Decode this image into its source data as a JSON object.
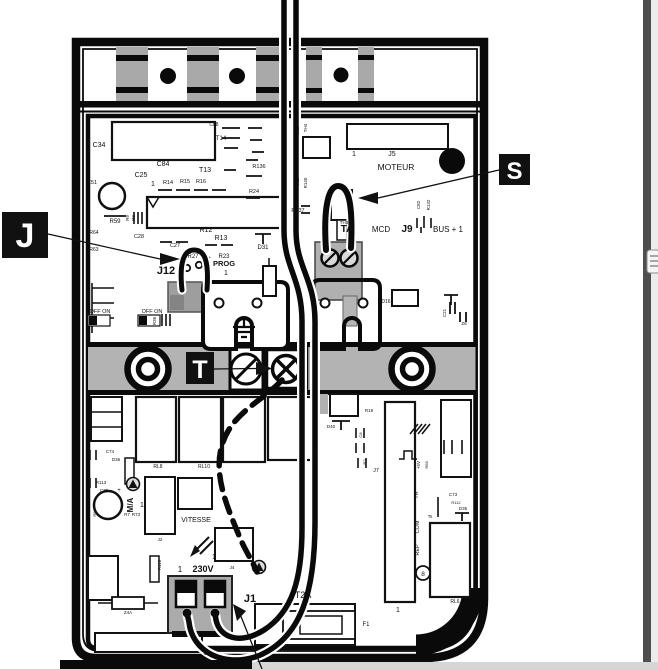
{
  "figure": {
    "type": "control-board-wiring-diagram",
    "accent_black": "#111111",
    "band_gray": "#b3b3b3",
    "cell_gray": "#a9a9a9",
    "block_gray": "#aeaeae",
    "page_strip_dark": "#4e4e4e",
    "page_strip_light": "#ececec",
    "bottom_bar_gray": "#d6d6d6"
  },
  "callouts": {
    "j": {
      "letter": "J"
    },
    "s": {
      "letter": "S"
    },
    "t": {
      "letter": "T"
    }
  },
  "board_labels": [
    {
      "t": "C34",
      "x": 99,
      "y": 147,
      "s": 7
    },
    {
      "t": "C84",
      "x": 163,
      "y": 166,
      "s": 7
    },
    {
      "t": "C25",
      "x": 141,
      "y": 177,
      "s": 7
    },
    {
      "t": "T13",
      "x": 205,
      "y": 172,
      "s": 7
    },
    {
      "t": "T14",
      "x": 221,
      "y": 140,
      "s": 6
    },
    {
      "t": "C88",
      "x": 214,
      "y": 126,
      "s": 5
    },
    {
      "t": "1",
      "x": 153,
      "y": 186,
      "s": 7
    },
    {
      "t": "R14",
      "x": 168,
      "y": 184,
      "s": 5.5
    },
    {
      "t": "R15",
      "x": 185,
      "y": 183,
      "s": 5.5
    },
    {
      "t": "R16",
      "x": 201,
      "y": 183,
      "s": 5.5
    },
    {
      "t": "R136",
      "x": 259,
      "y": 168,
      "s": 5.5
    },
    {
      "t": "R24",
      "x": 254,
      "y": 193,
      "s": 5.5
    },
    {
      "t": "C51",
      "x": 92,
      "y": 184,
      "s": 5.5
    },
    {
      "t": "R59",
      "x": 115,
      "y": 223,
      "s": 6
    },
    {
      "t": "R9",
      "x": 129,
      "y": 218,
      "s": 4.5,
      "r": 1
    },
    {
      "t": "R8",
      "x": 135,
      "y": 218,
      "s": 4.5,
      "r": 1
    },
    {
      "t": "R12",
      "x": 206,
      "y": 232,
      "s": 7
    },
    {
      "t": "R13",
      "x": 221,
      "y": 240,
      "s": 7
    },
    {
      "t": "C27",
      "x": 175,
      "y": 247,
      "s": 5.5
    },
    {
      "t": "C28",
      "x": 139,
      "y": 238,
      "s": 5.5
    },
    {
      "t": "D31",
      "x": 263,
      "y": 249,
      "s": 6
    },
    {
      "t": "R27",
      "x": 193,
      "y": 258,
      "s": 6
    },
    {
      "t": "R23",
      "x": 224,
      "y": 258,
      "s": 6
    },
    {
      "t": "R64",
      "x": 94,
      "y": 234,
      "s": 5
    },
    {
      "t": "R63",
      "x": 94,
      "y": 251,
      "s": 5
    },
    {
      "t": "J12",
      "x": 166,
      "y": 274,
      "s": 11,
      "b": 1
    },
    {
      "t": "PROG",
      "x": 224,
      "y": 266,
      "s": 7.5,
      "b": 1
    },
    {
      "t": "1",
      "x": 226,
      "y": 275,
      "s": 7
    },
    {
      "t": "OFF ON",
      "x": 100,
      "y": 313,
      "s": 5.5
    },
    {
      "t": "OFF ON",
      "x": 152,
      "y": 313,
      "s": 5.5
    },
    {
      "t": "R36",
      "x": 156,
      "y": 321,
      "s": 4.5,
      "r": 1
    },
    {
      "t": "U12",
      "x": 299,
      "y": 131,
      "s": 4.5,
      "r": 1
    },
    {
      "t": "TH4",
      "x": 307,
      "y": 128,
      "s": 4.5,
      "r": 1
    },
    {
      "t": "1",
      "x": 354,
      "y": 156,
      "s": 7
    },
    {
      "t": "J5",
      "x": 392,
      "y": 156,
      "s": 7
    },
    {
      "t": "MOTEUR",
      "x": 396,
      "y": 170,
      "s": 8.5
    },
    {
      "t": "U11",
      "x": 299,
      "y": 182,
      "s": 4.5,
      "r": 1
    },
    {
      "t": "R140",
      "x": 307,
      "y": 183,
      "s": 4.5,
      "r": 1
    },
    {
      "t": "R137",
      "x": 298,
      "y": 212,
      "s": 5.5
    },
    {
      "t": "TH3",
      "x": 344,
      "y": 224,
      "s": 4.5
    },
    {
      "t": "TA",
      "x": 347,
      "y": 232,
      "s": 10,
      "b": 1
    },
    {
      "t": "MCD",
      "x": 381,
      "y": 232,
      "s": 8
    },
    {
      "t": "J9",
      "x": 407,
      "y": 232,
      "s": 10,
      "b": 1
    },
    {
      "t": "BUS + 1",
      "x": 448,
      "y": 232,
      "s": 8
    },
    {
      "t": "C82",
      "x": 420,
      "y": 205,
      "s": 4.5,
      "r": 1
    },
    {
      "t": "R132",
      "x": 430,
      "y": 205,
      "s": 4.5,
      "r": 1
    },
    {
      "t": "C21",
      "x": 446,
      "y": 313,
      "s": 4.5,
      "r": 1
    },
    {
      "t": "Z6",
      "x": 464,
      "y": 325,
      "s": 4.5
    },
    {
      "t": "D16",
      "x": 386,
      "y": 303,
      "s": 5
    },
    {
      "t": "RL8",
      "x": 158,
      "y": 468,
      "s": 5
    },
    {
      "t": "RL10",
      "x": 204,
      "y": 468,
      "s": 5
    },
    {
      "t": "RL13",
      "x": 316,
      "y": 453,
      "s": 4.5,
      "r": 1
    },
    {
      "t": "D40",
      "x": 331,
      "y": 428,
      "s": 4.5
    },
    {
      "t": "R19",
      "x": 369,
      "y": 412,
      "s": 4.5
    },
    {
      "t": "C8",
      "x": 362,
      "y": 435,
      "s": 4,
      "r": 1
    },
    {
      "t": "R2",
      "x": 366,
      "y": 462,
      "s": 4,
      "r": 1
    },
    {
      "t": "J7",
      "x": 376,
      "y": 472,
      "s": 5.5
    },
    {
      "t": "C74",
      "x": 110,
      "y": 453,
      "s": 4.5
    },
    {
      "t": "D36",
      "x": 116,
      "y": 461,
      "s": 4.5
    },
    {
      "t": "R113",
      "x": 101,
      "y": 484,
      "s": 4.5
    },
    {
      "t": "C75",
      "x": 104,
      "y": 492,
      "s": 4.5
    },
    {
      "t": "+",
      "x": 119,
      "y": 492,
      "s": 6
    },
    {
      "t": "M/A",
      "x": 133,
      "y": 505,
      "s": 8,
      "b": 1,
      "r": 1
    },
    {
      "t": "1",
      "x": 142,
      "y": 507,
      "s": 7
    },
    {
      "t": "R7",
      "x": 127,
      "y": 516,
      "s": 4.5
    },
    {
      "t": "R73",
      "x": 136,
      "y": 516,
      "s": 4.5
    },
    {
      "t": "R98",
      "x": 90,
      "y": 513,
      "s": 4,
      "r": 1
    },
    {
      "t": "R99",
      "x": 96,
      "y": 513,
      "s": 4,
      "r": 1
    },
    {
      "t": "J2",
      "x": 160,
      "y": 541,
      "s": 4.5
    },
    {
      "t": "VITESSE",
      "x": 196,
      "y": 522,
      "s": 7
    },
    {
      "t": "R115",
      "x": 161,
      "y": 565,
      "s": 4.5,
      "r": 1
    },
    {
      "t": "1",
      "x": 180,
      "y": 572,
      "s": 8
    },
    {
      "t": "230V",
      "x": 203,
      "y": 572,
      "s": 9,
      "b": 1
    },
    {
      "t": "J4",
      "x": 232,
      "y": 569,
      "s": 4.5
    },
    {
      "t": "1",
      "x": 214,
      "y": 559,
      "s": 7
    },
    {
      "t": "J1",
      "x": 250,
      "y": 602,
      "s": 11,
      "b": 1
    },
    {
      "t": "T2A",
      "x": 303,
      "y": 598,
      "s": 9
    },
    {
      "t": "F1",
      "x": 366,
      "y": 626,
      "s": 6
    },
    {
      "t": "Z4A",
      "x": 128,
      "y": 614,
      "s": 4.5
    },
    {
      "t": "C1",
      "x": 207,
      "y": 655,
      "s": 5.5
    },
    {
      "t": "1",
      "x": 398,
      "y": 612,
      "s": 7
    },
    {
      "t": "+5V",
      "x": 420,
      "y": 465,
      "s": 4.5,
      "r": 1
    },
    {
      "t": "R68",
      "x": 428,
      "y": 465,
      "s": 4,
      "r": 1
    },
    {
      "t": "TR",
      "x": 418,
      "y": 495,
      "s": 5.5,
      "r": 1
    },
    {
      "t": "Ts",
      "x": 430,
      "y": 518,
      "s": 4.5
    },
    {
      "t": "COM",
      "x": 419,
      "y": 527,
      "s": 5.5,
      "r": 1
    },
    {
      "t": "REP",
      "x": 419,
      "y": 550,
      "s": 5.5,
      "r": 1
    },
    {
      "t": "C73",
      "x": 453,
      "y": 496,
      "s": 4.5
    },
    {
      "t": "R112",
      "x": 456,
      "y": 504,
      "s": 4
    },
    {
      "t": "D35",
      "x": 463,
      "y": 510,
      "s": 4.5
    },
    {
      "t": "RL6",
      "x": 455,
      "y": 603,
      "s": 5
    },
    {
      "t": "8",
      "x": 423,
      "y": 576,
      "s": 6.5
    }
  ]
}
